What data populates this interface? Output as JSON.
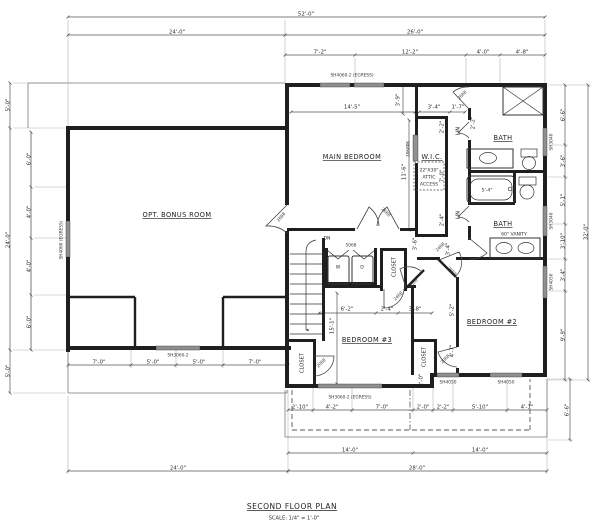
{
  "title_block": {
    "title": "SECOND FLOOR PLAN",
    "scale": "SCALE: 1/4\" = 1'-0\""
  },
  "rooms": [
    {
      "t": "OPT. BONUS ROOM",
      "x": 177,
      "y": 215,
      "u": true
    },
    {
      "t": "MAIN BEDROOM",
      "x": 352,
      "y": 157,
      "u": true
    },
    {
      "t": "W.I.C.",
      "x": 432,
      "y": 157,
      "u": true
    },
    {
      "t": "BATH",
      "x": 503,
      "y": 138,
      "u": true
    },
    {
      "t": "BATH",
      "x": 503,
      "y": 224,
      "u": true
    },
    {
      "t": "BEDROOM #2",
      "x": 492,
      "y": 322,
      "u": true
    },
    {
      "t": "BEDROOM #3",
      "x": 367,
      "y": 340,
      "u": true
    },
    {
      "t": "CLOSET",
      "x": 394,
      "y": 267,
      "r": -90,
      "v": true
    },
    {
      "t": "CLOSET",
      "x": 302,
      "y": 363,
      "r": -90,
      "v": true
    },
    {
      "t": "CLOSET",
      "x": 424,
      "y": 357,
      "r": -90,
      "v": true
    },
    {
      "t": "LIN",
      "x": 458,
      "y": 131,
      "r": -90,
      "v": true
    },
    {
      "t": "LIN",
      "x": 458,
      "y": 215,
      "r": -90,
      "v": true
    }
  ],
  "dims": [
    {
      "t": "52'-0\"",
      "x": 306,
      "y": 14
    },
    {
      "t": "24'-0\"",
      "x": 177,
      "y": 32
    },
    {
      "t": "26'-0\"",
      "x": 415,
      "y": 32
    },
    {
      "t": "7'-2\"",
      "x": 320,
      "y": 52
    },
    {
      "t": "12'-2\"",
      "x": 410,
      "y": 52
    },
    {
      "t": "4'-0\"",
      "x": 483,
      "y": 52
    },
    {
      "t": "4'-8\"",
      "x": 522,
      "y": 52
    },
    {
      "t": "5'-0\"",
      "x": 8,
      "y": 105,
      "r": -90
    },
    {
      "t": "24'-0\"",
      "x": 8,
      "y": 240,
      "r": -90
    },
    {
      "t": "5'-0\"",
      "x": 8,
      "y": 371,
      "r": -90
    },
    {
      "t": "6'-0\"",
      "x": 29,
      "y": 159,
      "r": -90
    },
    {
      "t": "4'-0\"",
      "x": 29,
      "y": 212,
      "r": -90
    },
    {
      "t": "4'-0\"",
      "x": 29,
      "y": 266,
      "r": -90
    },
    {
      "t": "6'-0\"",
      "x": 29,
      "y": 322,
      "r": -90
    },
    {
      "t": "6'-6\"",
      "x": 563,
      "y": 115,
      "r": -90
    },
    {
      "t": "3'-6\"",
      "x": 563,
      "y": 161,
      "r": -90
    },
    {
      "t": "5'-1\"",
      "x": 563,
      "y": 200,
      "r": -90
    },
    {
      "t": "3'-10\"",
      "x": 563,
      "y": 241,
      "r": -90
    },
    {
      "t": "3'-4\"",
      "x": 563,
      "y": 275,
      "r": -90
    },
    {
      "t": "9'-9\"",
      "x": 563,
      "y": 335,
      "r": -90
    },
    {
      "t": "32'-0\"",
      "x": 586,
      "y": 232,
      "r": -90
    },
    {
      "t": "6'-6\"",
      "x": 567,
      "y": 410,
      "r": -90
    },
    {
      "t": "7'-0\"",
      "x": 99,
      "y": 362
    },
    {
      "t": "5'-0\"",
      "x": 153,
      "y": 362
    },
    {
      "t": "5'-0\"",
      "x": 199,
      "y": 362
    },
    {
      "t": "7'-0\"",
      "x": 255,
      "y": 362
    },
    {
      "t": "24'-0\"",
      "x": 178,
      "y": 468
    },
    {
      "t": "2'-10\"",
      "x": 300,
      "y": 407
    },
    {
      "t": "4'-2\"",
      "x": 332,
      "y": 407
    },
    {
      "t": "7'-0\"",
      "x": 382,
      "y": 407
    },
    {
      "t": "2'-0\"",
      "x": 423,
      "y": 407
    },
    {
      "t": "2'-2\"",
      "x": 443,
      "y": 407
    },
    {
      "t": "5'-10\"",
      "x": 480,
      "y": 407
    },
    {
      "t": "4'-1\"",
      "x": 527,
      "y": 407
    },
    {
      "t": "14'-0\"",
      "x": 350,
      "y": 450
    },
    {
      "t": "14'-0\"",
      "x": 480,
      "y": 450
    },
    {
      "t": "28'-0\"",
      "x": 417,
      "y": 468
    },
    {
      "t": "14'-5\"",
      "x": 352,
      "y": 107
    },
    {
      "t": "3'-4\"",
      "x": 434,
      "y": 107
    },
    {
      "t": "1'-7\"",
      "x": 458,
      "y": 107
    },
    {
      "t": "3'-9\"",
      "x": 398,
      "y": 100,
      "r": -90
    },
    {
      "t": "11'-6\"",
      "x": 404,
      "y": 172,
      "r": -90
    },
    {
      "t": "2'-2\"",
      "x": 442,
      "y": 127,
      "r": -90
    },
    {
      "t": "7'-0\"",
      "x": 442,
      "y": 176,
      "r": -90
    },
    {
      "t": "2'-4\"",
      "x": 442,
      "y": 220,
      "r": -90
    },
    {
      "t": "3'-6\"",
      "x": 415,
      "y": 244,
      "r": -90
    },
    {
      "t": "6'-2\"",
      "x": 347,
      "y": 309
    },
    {
      "t": "2'-4\"",
      "x": 387,
      "y": 309
    },
    {
      "t": "3'-8\"",
      "x": 415,
      "y": 309
    },
    {
      "t": "15'-1\"",
      "x": 332,
      "y": 326,
      "r": -90
    },
    {
      "t": "3'-4\"",
      "x": 448,
      "y": 249,
      "r": -90
    },
    {
      "t": "5'-2\"",
      "x": 452,
      "y": 310,
      "r": -90
    },
    {
      "t": "4'-7\"",
      "x": 452,
      "y": 351,
      "r": -90
    },
    {
      "t": "2'-0\"",
      "x": 421,
      "y": 380,
      "r": -90
    },
    {
      "t": "2'-2\"",
      "x": 473,
      "y": 123,
      "r": -90
    }
  ],
  "doors": [
    {
      "t": "2668",
      "x": 281,
      "y": 217,
      "r": -50
    },
    {
      "t": "2668",
      "x": 386,
      "y": 212,
      "r": 45
    },
    {
      "t": "2868PK",
      "x": 408,
      "y": 149,
      "r": -90
    },
    {
      "t": "2668",
      "x": 462,
      "y": 95,
      "r": -45
    },
    {
      "t": "2468",
      "x": 440,
      "y": 247,
      "r": -45
    },
    {
      "t": "2668",
      "x": 452,
      "y": 271,
      "r": 45
    },
    {
      "t": "2068",
      "x": 413,
      "y": 283,
      "r": -45
    },
    {
      "t": "2468",
      "x": 398,
      "y": 296,
      "r": -45
    },
    {
      "t": "2068",
      "x": 321,
      "y": 363,
      "r": -45
    },
    {
      "t": "2068",
      "x": 445,
      "y": 359,
      "r": -45
    },
    {
      "t": "5068",
      "x": 351,
      "y": 245
    }
  ],
  "windows": [
    {
      "t": "SH4060-2 (EGRESS)",
      "x": 352,
      "y": 75
    },
    {
      "t": "SH4060 (EGRESS)",
      "x": 61,
      "y": 240,
      "r": -90
    },
    {
      "t": "SH3060-2",
      "x": 178,
      "y": 355
    },
    {
      "t": "SH3060-2 (EGRESS)",
      "x": 350,
      "y": 397
    },
    {
      "t": "SH4050",
      "x": 448,
      "y": 382
    },
    {
      "t": "SH4050",
      "x": 506,
      "y": 382
    },
    {
      "t": "SH3040",
      "x": 551,
      "y": 142,
      "r": -90
    },
    {
      "t": "SH3040",
      "x": 551,
      "y": 221,
      "r": -90
    },
    {
      "t": "SH4050",
      "x": 551,
      "y": 282,
      "r": -90
    }
  ],
  "misc": [
    {
      "t": "DN",
      "x": 327,
      "y": 238,
      "s": 5
    },
    {
      "t": "W",
      "x": 338,
      "y": 267,
      "s": 5.5
    },
    {
      "t": "D",
      "x": 362,
      "y": 267,
      "s": 5.5
    },
    {
      "t": "60\" VANITY",
      "x": 514,
      "y": 234,
      "s": 4.5
    },
    {
      "t": "5'-4\"",
      "x": 487,
      "y": 190,
      "s": 4.5
    },
    {
      "t": "22\"X30\"",
      "x": 429,
      "y": 170,
      "s": 4
    },
    {
      "t": "ATTIC",
      "x": 429,
      "y": 177,
      "s": 4
    },
    {
      "t": "ACCESS",
      "x": 429,
      "y": 184,
      "s": 4
    }
  ]
}
